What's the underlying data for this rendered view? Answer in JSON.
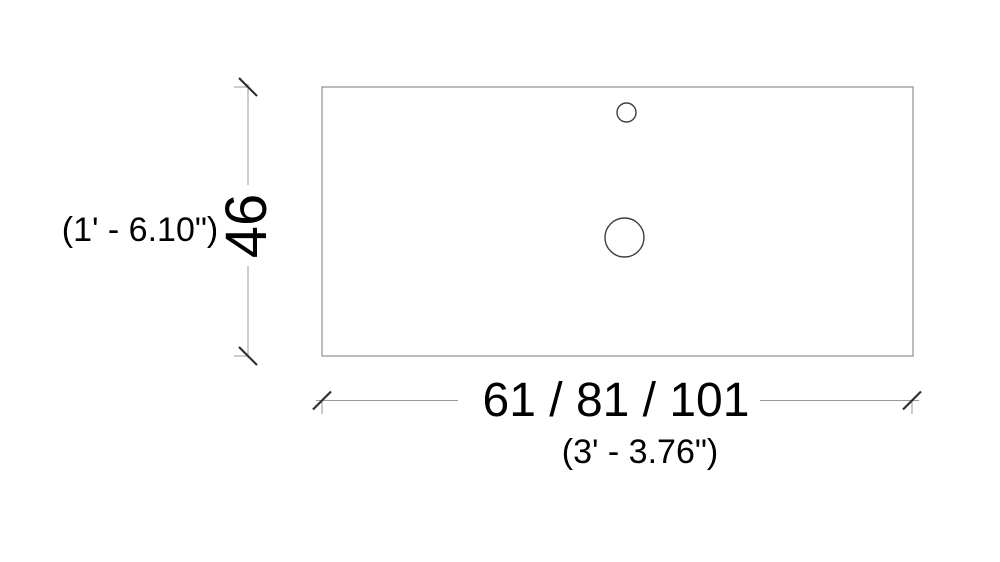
{
  "drawing": {
    "view": "countertop top view",
    "dimensions": {
      "height": {
        "metric": "46",
        "imperial": "(1' - 6.10\")"
      },
      "width": {
        "metric": "61 / 81 / 101",
        "imperial": "(3' - 3.76\")"
      }
    },
    "colors": {
      "background": "#ffffff",
      "object_line": "#8f8f8f",
      "hole_line": "#3f3f3f",
      "dimension_line": "#9a9a9a",
      "tick": "#2f2f2f",
      "text": "#000000"
    }
  }
}
